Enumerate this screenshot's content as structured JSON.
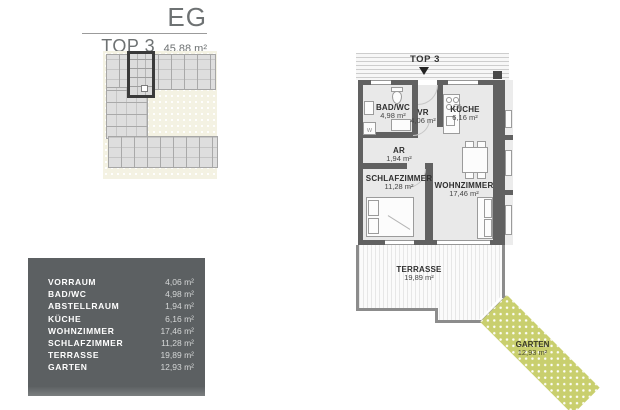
{
  "header": {
    "floor_label": "EG",
    "unit_label": "TOP 3",
    "total_area": "45,88 m²"
  },
  "area_table": {
    "rows": [
      {
        "label": "VORRAUM",
        "value": "4,06 m²"
      },
      {
        "label": "BAD/WC",
        "value": "4,98 m²"
      },
      {
        "label": "ABSTELLRAUM",
        "value": "1,94 m²"
      },
      {
        "label": "KÜCHE",
        "value": "6,16 m²"
      },
      {
        "label": "WOHNZIMMER",
        "value": "17,46 m²"
      },
      {
        "label": "SCHLAFZIMMER",
        "value": "11,28 m²"
      },
      {
        "label": "TERRASSE",
        "value": "19,89 m²"
      },
      {
        "label": "GARTEN",
        "value": "12,93 m²"
      }
    ]
  },
  "floor_plan": {
    "entrance_label": "TOP 3",
    "washer_label": "W",
    "rooms": {
      "bad": {
        "name": "BAD/WC",
        "area": "4,98 m²"
      },
      "vr": {
        "name": "VR",
        "area": "4,06 m²"
      },
      "kueche": {
        "name": "KÜCHE",
        "area": "6,16 m²"
      },
      "ar": {
        "name": "AR",
        "area": "1,94 m²"
      },
      "schlafzimmer": {
        "name": "SCHLAFZIMMER",
        "area": "11,28 m²"
      },
      "wohnzimmer": {
        "name": "WOHNZIMMER",
        "area": "17,46 m²"
      },
      "terrasse": {
        "name": "TERRASSE",
        "area": "19,89 m²"
      },
      "garten": {
        "name": "GARTEN",
        "area": "12,93 m²"
      }
    }
  },
  "colors": {
    "garden_green": "#c9cf6e",
    "table_bg": "#5c6062",
    "wall_gray": "#616161",
    "site_cream": "#f4f2e3"
  }
}
